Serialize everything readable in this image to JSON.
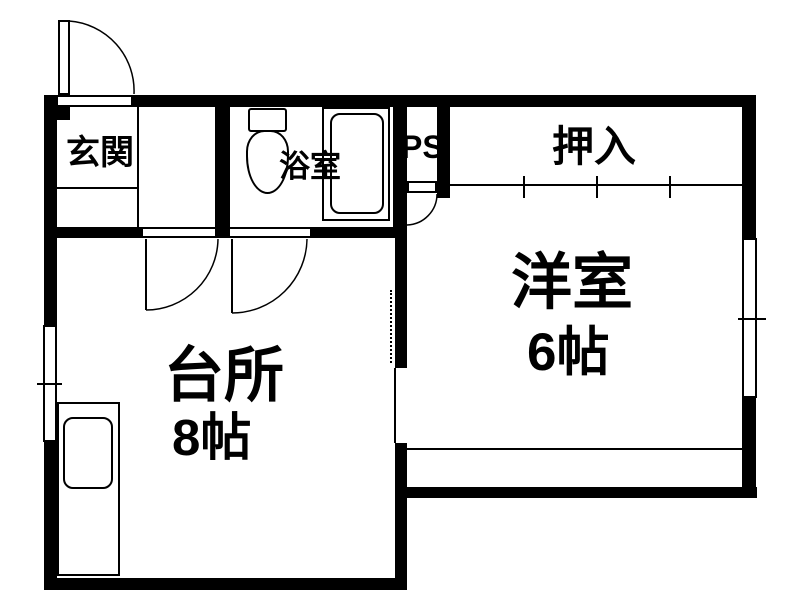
{
  "rooms": {
    "genkan": {
      "label": "玄関"
    },
    "bathroom": {
      "label": "浴室"
    },
    "ps": {
      "label": "PS"
    },
    "oshiire": {
      "label": "押入"
    },
    "western": {
      "label": "洋室",
      "size": "6帖"
    },
    "kitchen": {
      "label": "台所",
      "size": "8帖"
    }
  },
  "colors": {
    "line": "#000000",
    "background": "#ffffff"
  }
}
